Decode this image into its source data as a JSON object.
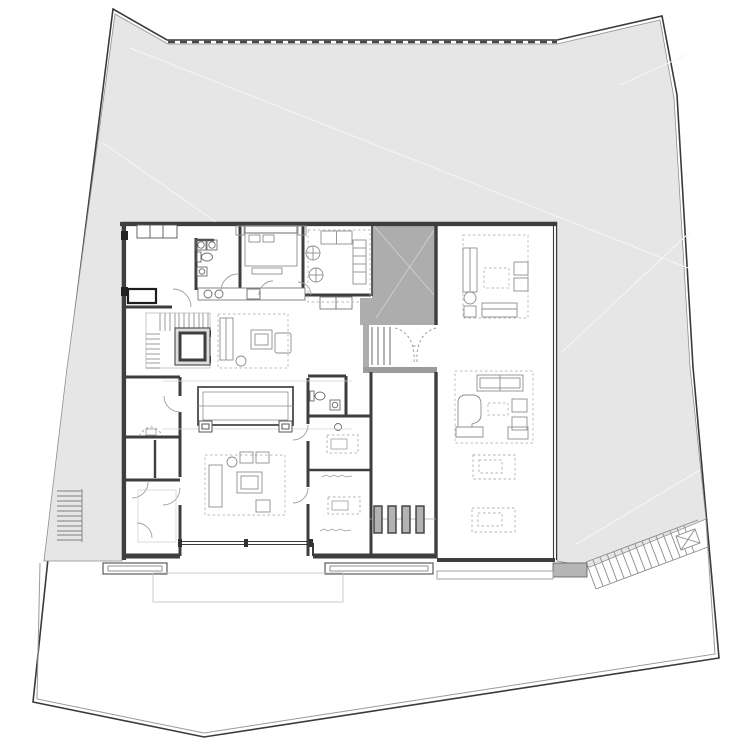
{
  "document": {
    "title": "Residential ground-floor site plan",
    "type": "architectural-floor-plan",
    "floor": "ground floor"
  },
  "palette": {
    "background": "#ffffff",
    "site_fill": "#e6e6e6",
    "site_boundary": "#3a3a3a",
    "inner_boundary": "#9a9a9a",
    "sight_line": "#f5f5f5",
    "wall": "#3e3e3e",
    "wall_light": "#777777",
    "glass": "#3a3a3a",
    "courtyard_fill": "#adadad",
    "courtyard_sight": "#cfcfcf",
    "corridor_band": "#9c9c9c",
    "slat_fill": "#b3b3b3",
    "slat_stroke": "#3c3c3c",
    "step_block": "#b5b5b5",
    "furniture": "#8e8e8e",
    "furniture_faint": "#b5b5b5",
    "fixture": "#6a6a6a",
    "door_arc": "#9e9e9e",
    "stair_tread": "#828282",
    "faint_terrace": "#c6c6c6",
    "annotation": "#9a9a9a"
  },
  "site": {
    "boundary": "property line",
    "north_edge": "fence line",
    "features": [
      "garden terrace",
      "exterior side stair",
      "diagonal garden stair",
      "spa marker",
      "lower yard"
    ]
  },
  "house": {
    "rooms": [
      "entry hall",
      "bathroom",
      "bedroom",
      "dining room",
      "kitchen counter",
      "stair and elevator core",
      "living room",
      "media lounge",
      "powder room",
      "study rooms",
      "garage and storage",
      "service corridor with deck slats",
      "great room with grand piano",
      "covered courtyard"
    ]
  }
}
